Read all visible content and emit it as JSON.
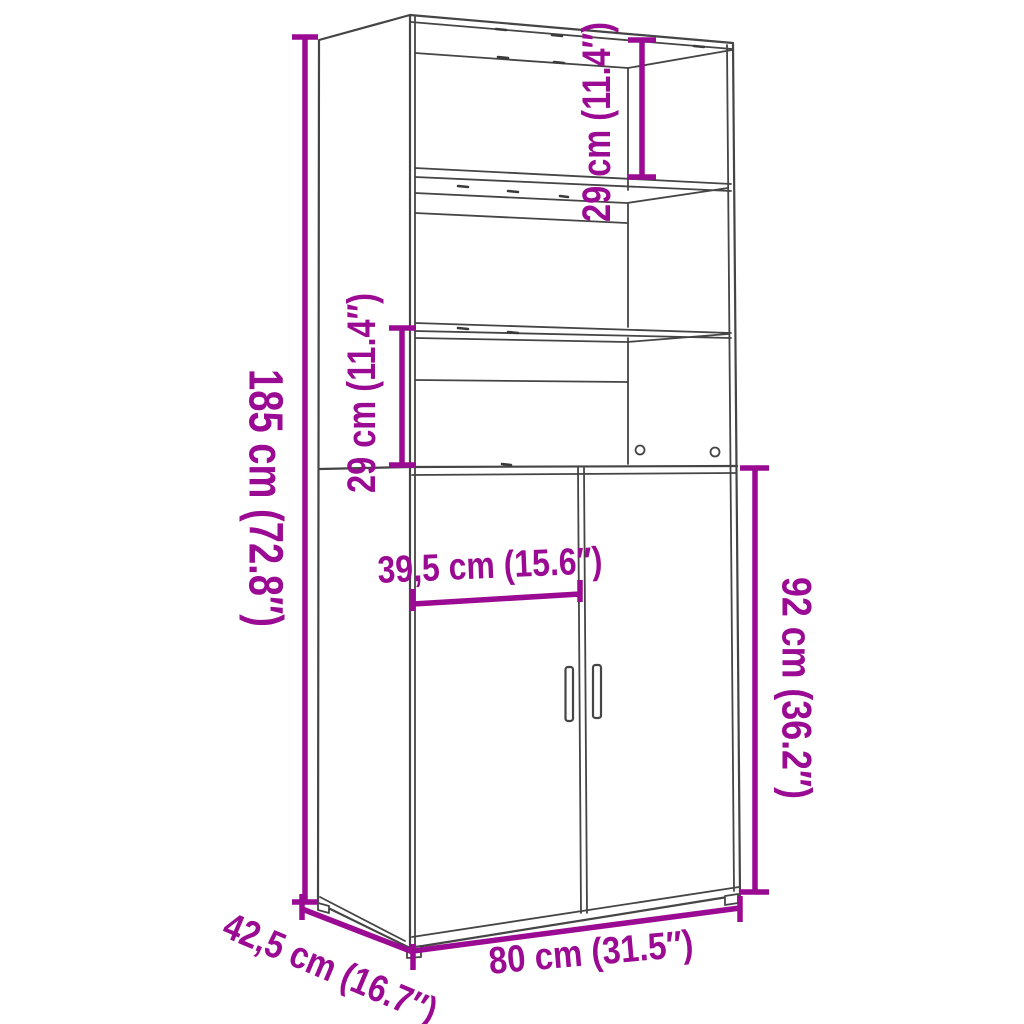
{
  "diagram": {
    "kind": "furniture-dimension-diagram",
    "style": {
      "accent_color": "#9B0A92",
      "line_color": "#454545",
      "background": "#FFFFFF"
    },
    "labels": {
      "height": "185 cm (72.8″)",
      "width": "80 cm (31.5″)",
      "depth": "42,5 cm (16.7″)",
      "shelf_top": "29 cm (11.4″)",
      "shelf_bottom": "29 cm (11.4″)",
      "door_width": "39,5 cm (15.6″)",
      "door_height": "92 cm (36.2″)"
    }
  }
}
